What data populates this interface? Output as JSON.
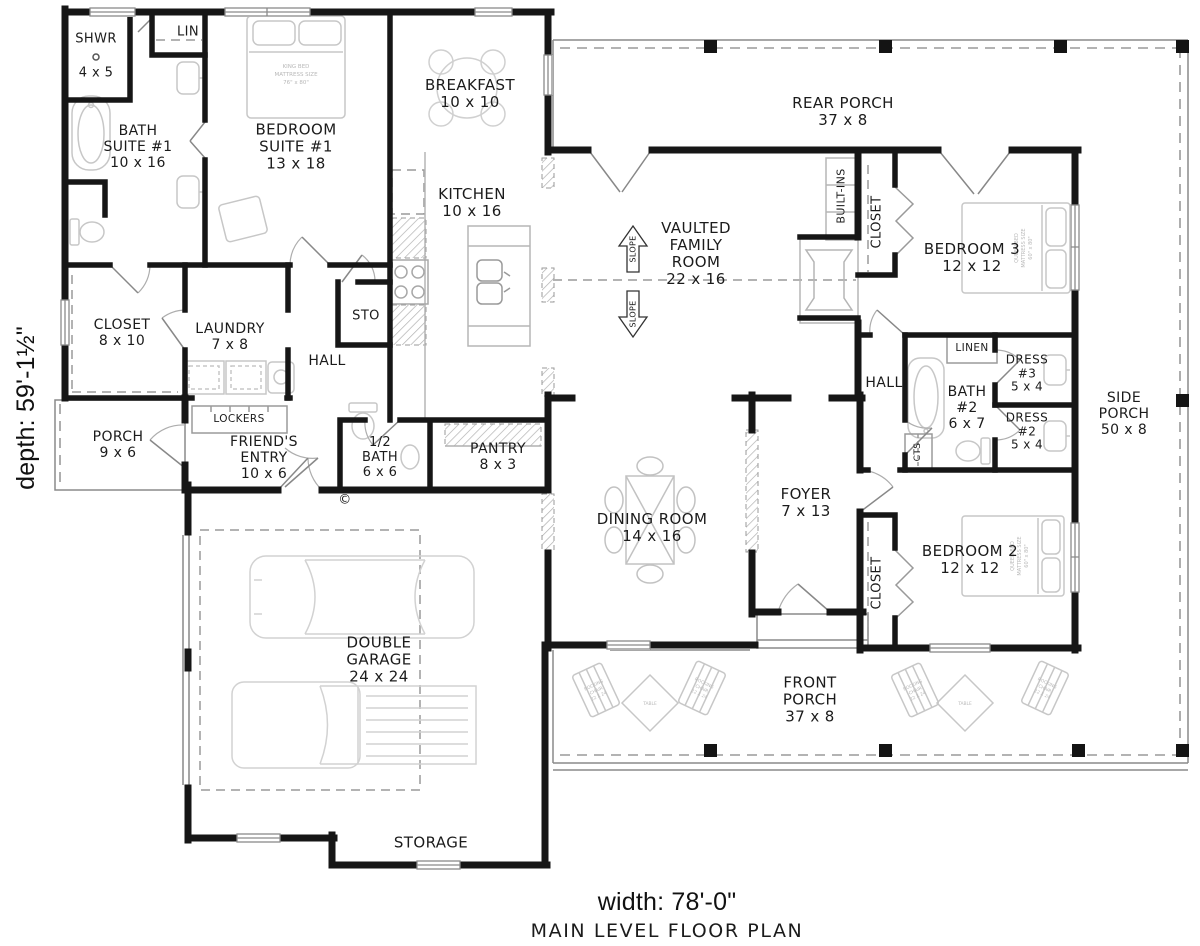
{
  "plan": {
    "title": "MAIN LEVEL FLOOR PLAN",
    "width_label": "width: 78'-0\"",
    "depth_label": "depth: 59'-1½\"",
    "copyright": "©"
  },
  "rooms": {
    "shwr": {
      "l1": "SHWR",
      "l2": "4 x 5"
    },
    "lin": {
      "l1": "LIN"
    },
    "bath_suite1": {
      "l1": "BATH",
      "l2": "SUITE #1",
      "l3": "10 x 16"
    },
    "bedroom_suite1": {
      "l1": "BEDROOM",
      "l2": "SUITE #1",
      "l3": "13 x 18"
    },
    "breakfast": {
      "l1": "BREAKFAST",
      "l2": "10 x 10"
    },
    "kitchen": {
      "l1": "KITCHEN",
      "l2": "10 x 16"
    },
    "rear_porch": {
      "l1": "REAR PORCH",
      "l2": "37 x 8"
    },
    "family_room": {
      "l1": "VAULTED",
      "l2": "FAMILY",
      "l3": "ROOM",
      "l4": "22 x 16"
    },
    "built_ins": {
      "l1": "BUILT-INS"
    },
    "closet_bed3": {
      "l1": "CLOSET"
    },
    "bedroom3": {
      "l1": "BEDROOM 3",
      "l2": "12 x 12"
    },
    "closet_8x10": {
      "l1": "CLOSET",
      "l2": "8 x 10"
    },
    "laundry": {
      "l1": "LAUNDRY",
      "l2": "7 x 8"
    },
    "sto": {
      "l1": "STO"
    },
    "hall_left": {
      "l1": "HALL"
    },
    "hall_right": {
      "l1": "HALL"
    },
    "lockers": {
      "l1": "LOCKERS"
    },
    "linen": {
      "l1": "LINEN"
    },
    "dress3": {
      "l1": "DRESS",
      "l2": "#3",
      "l3": "5 x 4"
    },
    "bath2": {
      "l1": "BATH",
      "l2": "#2",
      "l3": "6 x 7"
    },
    "dress2": {
      "l1": "DRESS",
      "l2": "#2",
      "l3": "5 x 4"
    },
    "cts": {
      "l1": "CTS"
    },
    "side_porch": {
      "l1": "SIDE",
      "l2": "PORCH",
      "l3": "50 x 8"
    },
    "porch_9x6": {
      "l1": "PORCH",
      "l2": "9 x 6"
    },
    "friends_entry": {
      "l1": "FRIEND'S",
      "l2": "ENTRY",
      "l3": "10 x 6"
    },
    "half_bath": {
      "l1": "1/2",
      "l2": "BATH",
      "l3": "6 x 6"
    },
    "pantry": {
      "l1": "PANTRY",
      "l2": "8 x 3"
    },
    "dining": {
      "l1": "DINING ROOM",
      "l2": "14 x 16"
    },
    "foyer": {
      "l1": "FOYER",
      "l2": "7 x 13"
    },
    "closet_bed2": {
      "l1": "CLOSET"
    },
    "bedroom2": {
      "l1": "BEDROOM 2",
      "l2": "12 x 12"
    },
    "garage": {
      "l1": "DOUBLE",
      "l2": "GARAGE",
      "l3": "24 x 24"
    },
    "front_porch": {
      "l1": "FRONT",
      "l2": "PORCH",
      "l3": "37 x 8"
    },
    "storage": {
      "l1": "STORAGE"
    }
  },
  "annotations": {
    "slope": "SLOPE",
    "king": {
      "l1": "KING BED",
      "l2": "MATTRESS SIZE",
      "l3": "76\" x 80\""
    },
    "queen": {
      "l1": "QUEEN BED",
      "l2": "MATTRESS SIZE",
      "l3": "60\" x 80\""
    },
    "rocking": {
      "l1": "ROCKING",
      "l2": "CHAIR",
      "l3": "22 X 24"
    },
    "table": "TABLE"
  },
  "colors": {
    "wall": "#161616",
    "thin_line": "#8a8a8a",
    "furniture": "#c7c7c7",
    "hatch": "#b0b0b0"
  }
}
